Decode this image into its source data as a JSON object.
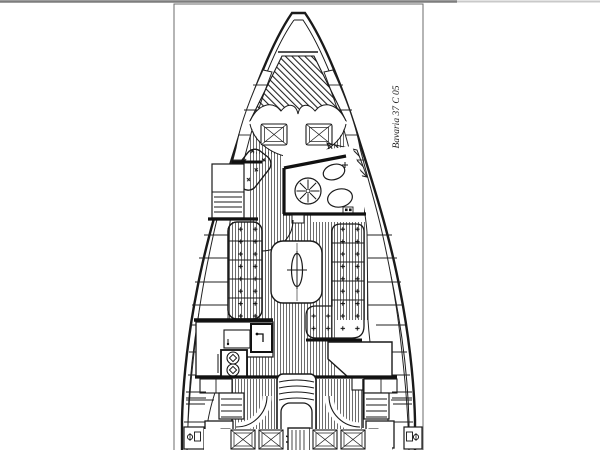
{
  "page": {
    "background": "#ffffff",
    "scan_edge_color": "#7d7d7d",
    "frame_color": "#6b6b6b"
  },
  "plan": {
    "label": "Bavaria 37 C 05",
    "ink_color": "#1a1a1a",
    "paper_color": "#ffffff",
    "floor_stripe_color": "#3a3a3a"
  }
}
